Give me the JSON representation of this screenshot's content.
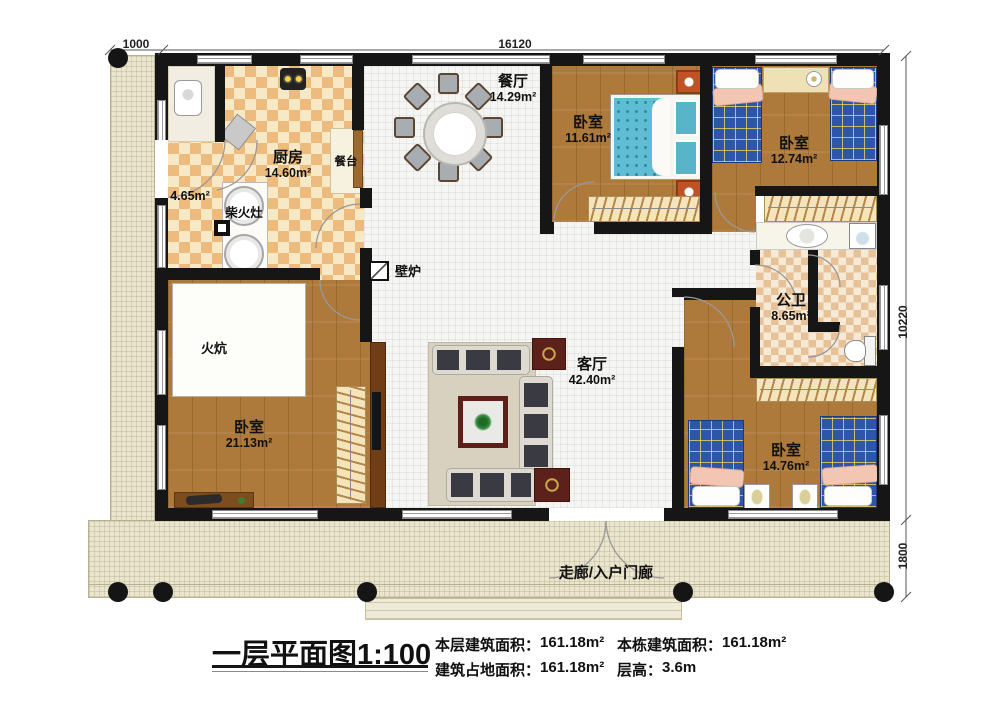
{
  "dimensions": {
    "porch_left_width": "1000",
    "house_width": "16120",
    "house_depth": "10220",
    "porch_bottom_depth": "1800"
  },
  "rooms": {
    "dining": {
      "name": "餐厅",
      "area": "14.29m²"
    },
    "bedroom1": {
      "name": "卧室",
      "area": "11.61m²"
    },
    "bedroom2": {
      "name": "卧室",
      "area": "12.74m²"
    },
    "kitchen": {
      "name": "厨房",
      "area": "14.60m²"
    },
    "pantry": {
      "area": "4.65m²"
    },
    "bathroom": {
      "name": "公卫",
      "area": "8.65m²"
    },
    "living": {
      "name": "客厅",
      "area": "42.40m²"
    },
    "bedroom3": {
      "name": "卧室",
      "area": "21.13m²"
    },
    "bedroom4": {
      "name": "卧室",
      "area": "14.76m²"
    }
  },
  "features": {
    "counter": "餐台",
    "wood_stove": "柴火灶",
    "fireplace": "壁炉",
    "kang": "火炕",
    "porch": "走廊/入户门廊"
  },
  "footer": {
    "title": "一层平面图1:100",
    "stats": [
      {
        "label": "本层建筑面积：",
        "value": "161.18m²"
      },
      {
        "label": "本栋建筑面积：",
        "value": "161.18m²"
      },
      {
        "label": "建筑占地面积：",
        "value": "161.18m²"
      },
      {
        "label": "层高：",
        "value": "3.6m"
      }
    ]
  },
  "colors": {
    "wall": "#161616",
    "wood_floor": "#ad7a3c",
    "porch": "#eae5cf",
    "bed_plaid_blue": "#2e56a8",
    "mattress_teal": "#5ebdd2"
  }
}
